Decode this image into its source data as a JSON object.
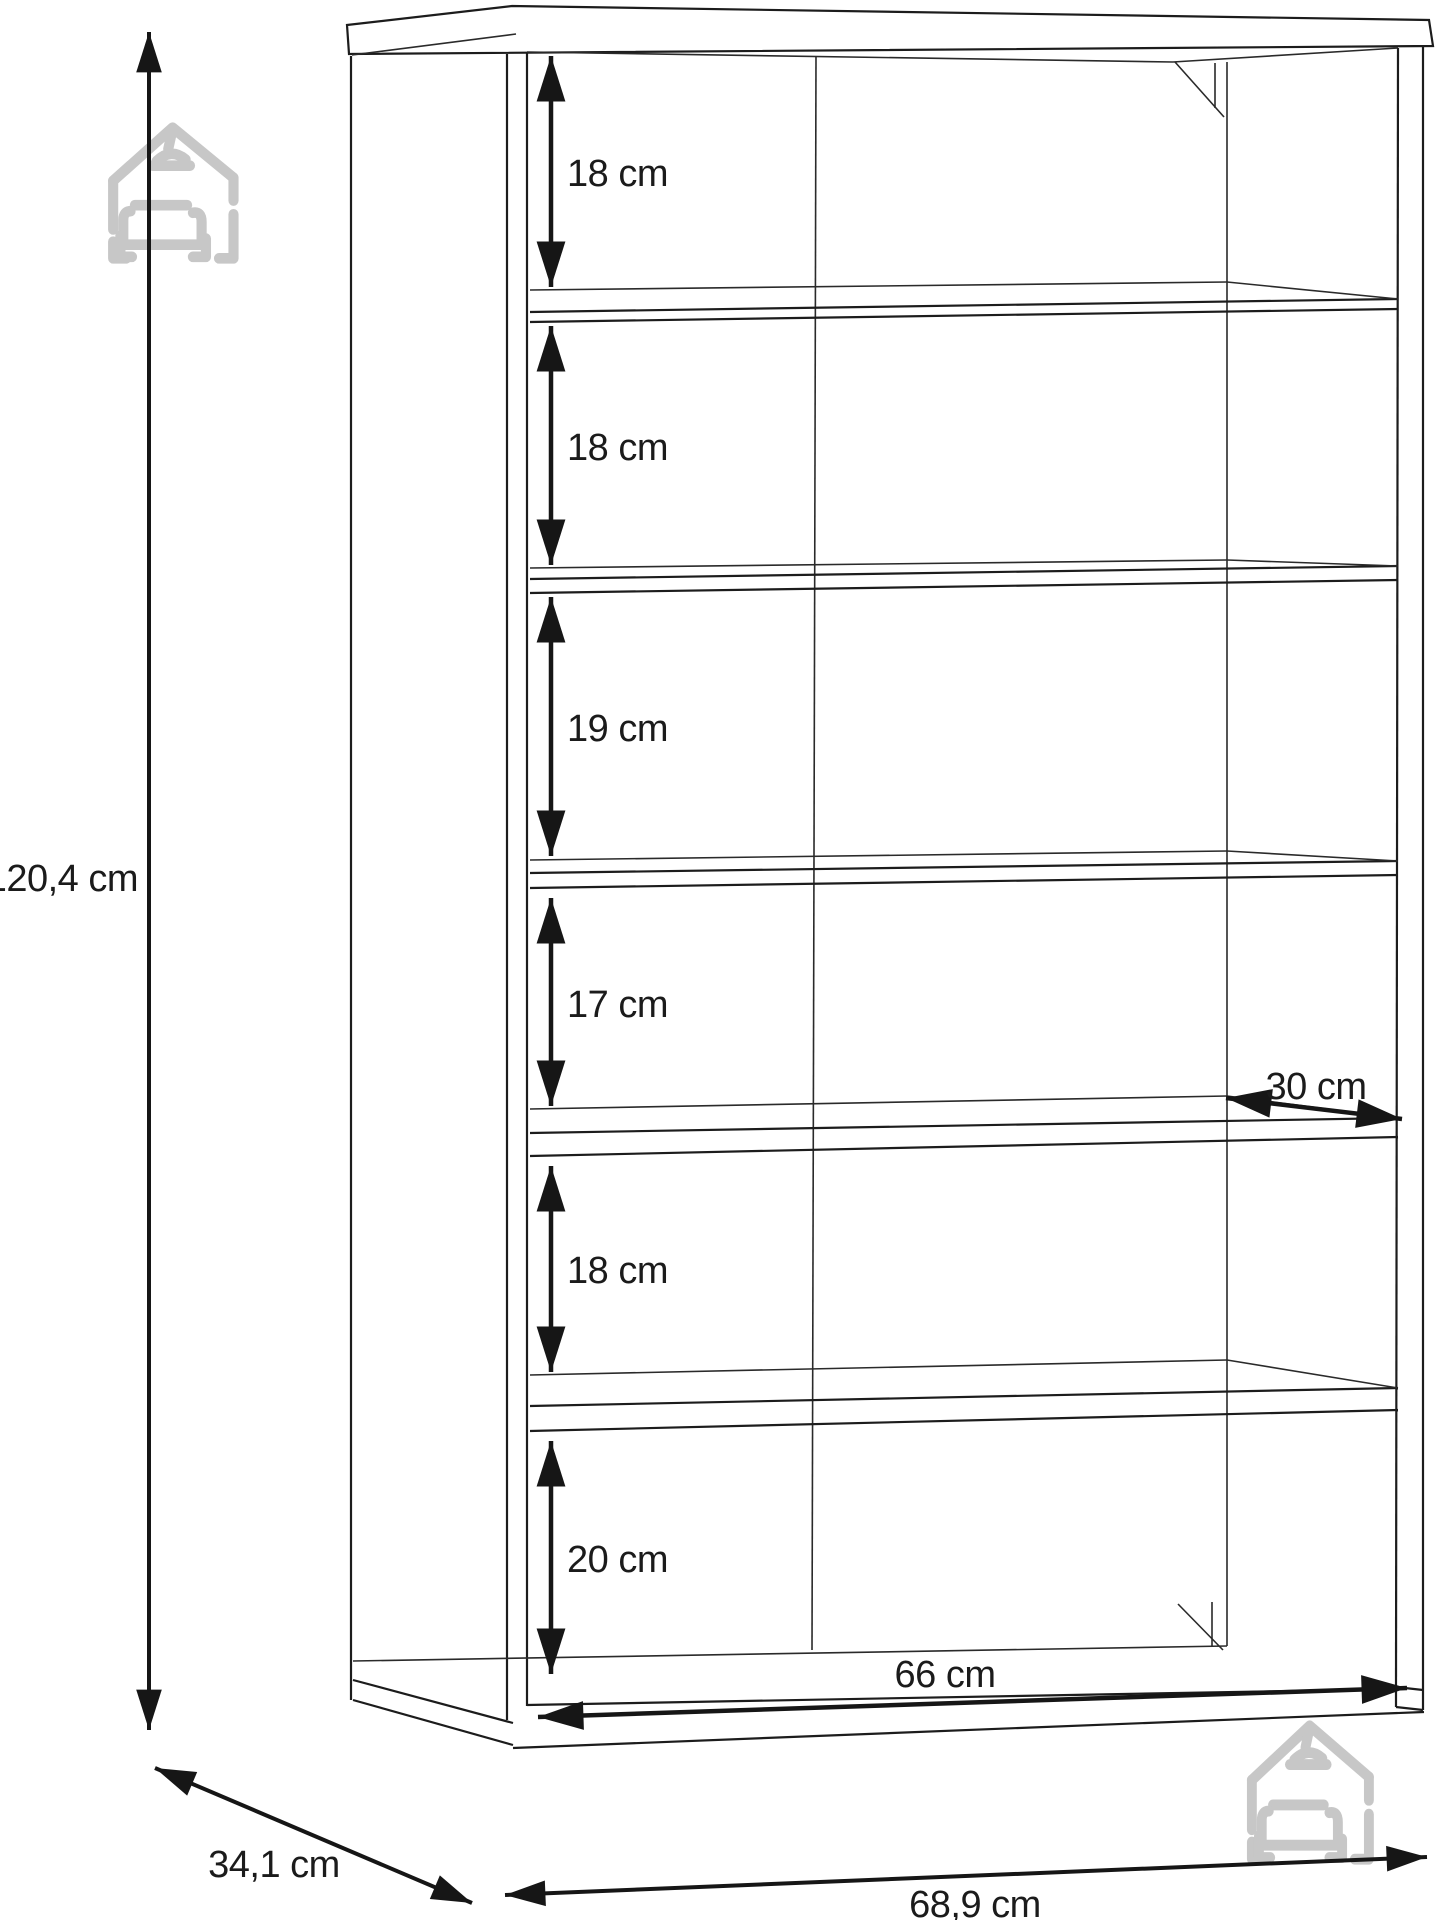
{
  "page": {
    "background": "#ffffff",
    "kind": "furniture-dimension-diagram",
    "subject": "open shelf cabinet with 6 compartments, 5 shelves and middle divider"
  },
  "drawing": {
    "unit": "cm",
    "line_color": "#1c1c1c",
    "watermark_color": "#c7c7c7",
    "labels": {
      "total_height": "120,4 cm",
      "depth": "34,1 cm",
      "outer_width": "68,9 cm",
      "inner_width": "66 cm",
      "shelf_depth": "30 cm"
    },
    "compartments": [
      "18 cm",
      "18 cm",
      "19 cm",
      "17 cm",
      "18 cm",
      "20 cm"
    ],
    "watermark": "house-with-sofa-and-pendant-lamp logo, shown top-left and bottom-right"
  }
}
